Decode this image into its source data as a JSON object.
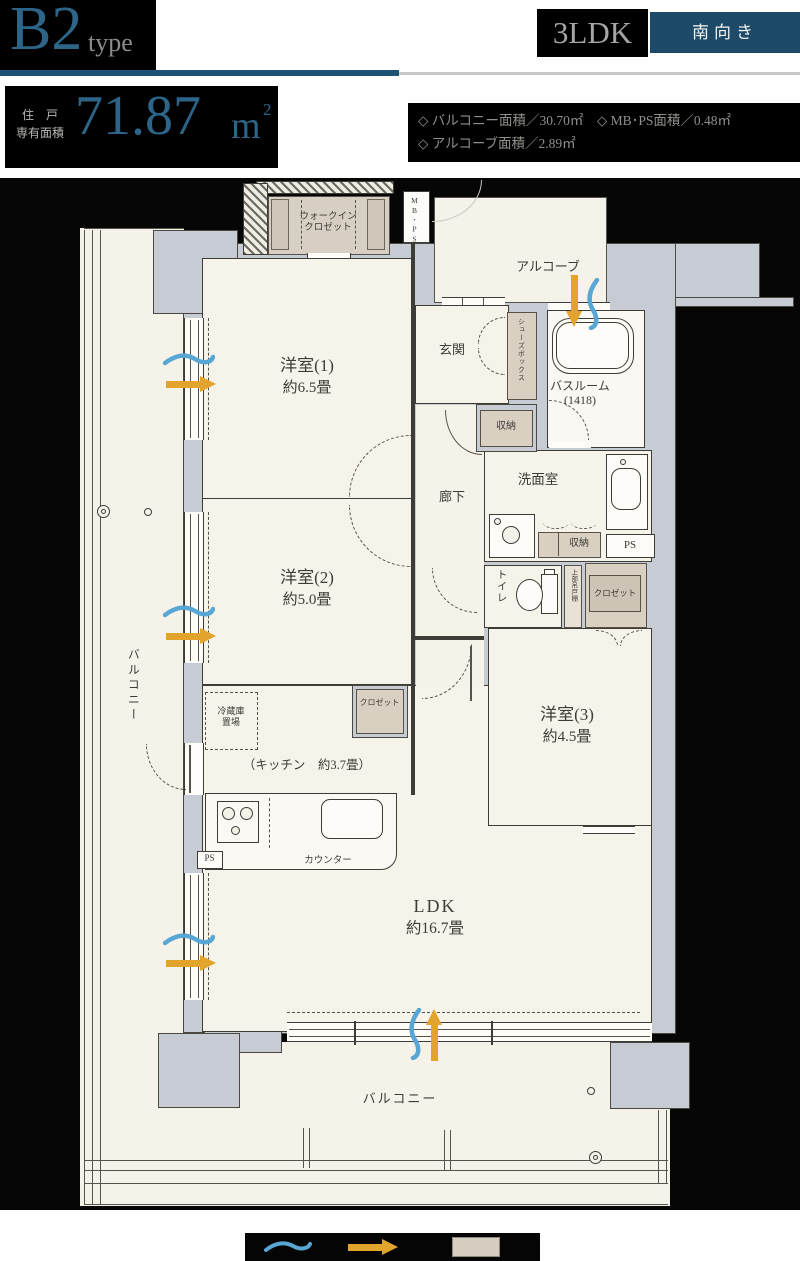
{
  "header": {
    "plan_type": "B2",
    "plan_type_suffix": "type",
    "layout_badge": "3LDK",
    "direction_badge": "南向き",
    "area_label_line1": "住　戸",
    "area_label_line2": "専有面積",
    "area_value": "71.87",
    "area_unit_base": "m",
    "area_unit_sup": "2",
    "detail_line1": "◇ バルコニー面積／30.70㎡　◇ MB･PS面積／0.48㎡",
    "detail_line2": "◇ アルコーブ面積／2.89㎡"
  },
  "rooms": {
    "western1_name": "洋室(1)",
    "western1_size": "約6.5畳",
    "western2_name": "洋室(2)",
    "western2_size": "約5.0畳",
    "western3_name": "洋室(3)",
    "western3_size": "約4.5畳",
    "ldk_name": "LDK",
    "ldk_size": "約16.7畳",
    "kitchen_label": "（キッチン　約3.7畳）",
    "entrance": "玄関",
    "hallway": "廊下",
    "washroom": "洗面室",
    "bathroom_name": "バスルーム",
    "bathroom_size": "(1418)",
    "toilet": "トイレ",
    "alcove": "アルコーブ",
    "balcony_left": "バルコニー",
    "balcony_bottom": "バルコニー",
    "walkin_line1": "ウォークイン",
    "walkin_line2": "クロゼット"
  },
  "storage": {
    "shoes_box": "シューズボックス",
    "storage_entrance": "収納",
    "storage_washroom": "収納",
    "closet_w2": "クロゼット",
    "closet_w3": "クロゼット",
    "upper_cabinet": "上部吊戸棚",
    "fridge_line1": "冷蔵庫",
    "fridge_line2": "置場",
    "counter": "カウンター",
    "mbps": "MB･PS",
    "ps_washroom": "PS",
    "ps_kitchen": "PS"
  },
  "colors": {
    "accent_blue": "#2d6589",
    "underline_blue": "#1c5273",
    "badge_teal": "#1c4a68",
    "wall_gray": "#c6cbd4",
    "floor_cream": "#f6f3ea",
    "storage_beige": "#d9d0c2",
    "arrow_orange": "#e3a42d",
    "wave_blue": "#57a6d4",
    "line_dark": "#3e3c37"
  }
}
